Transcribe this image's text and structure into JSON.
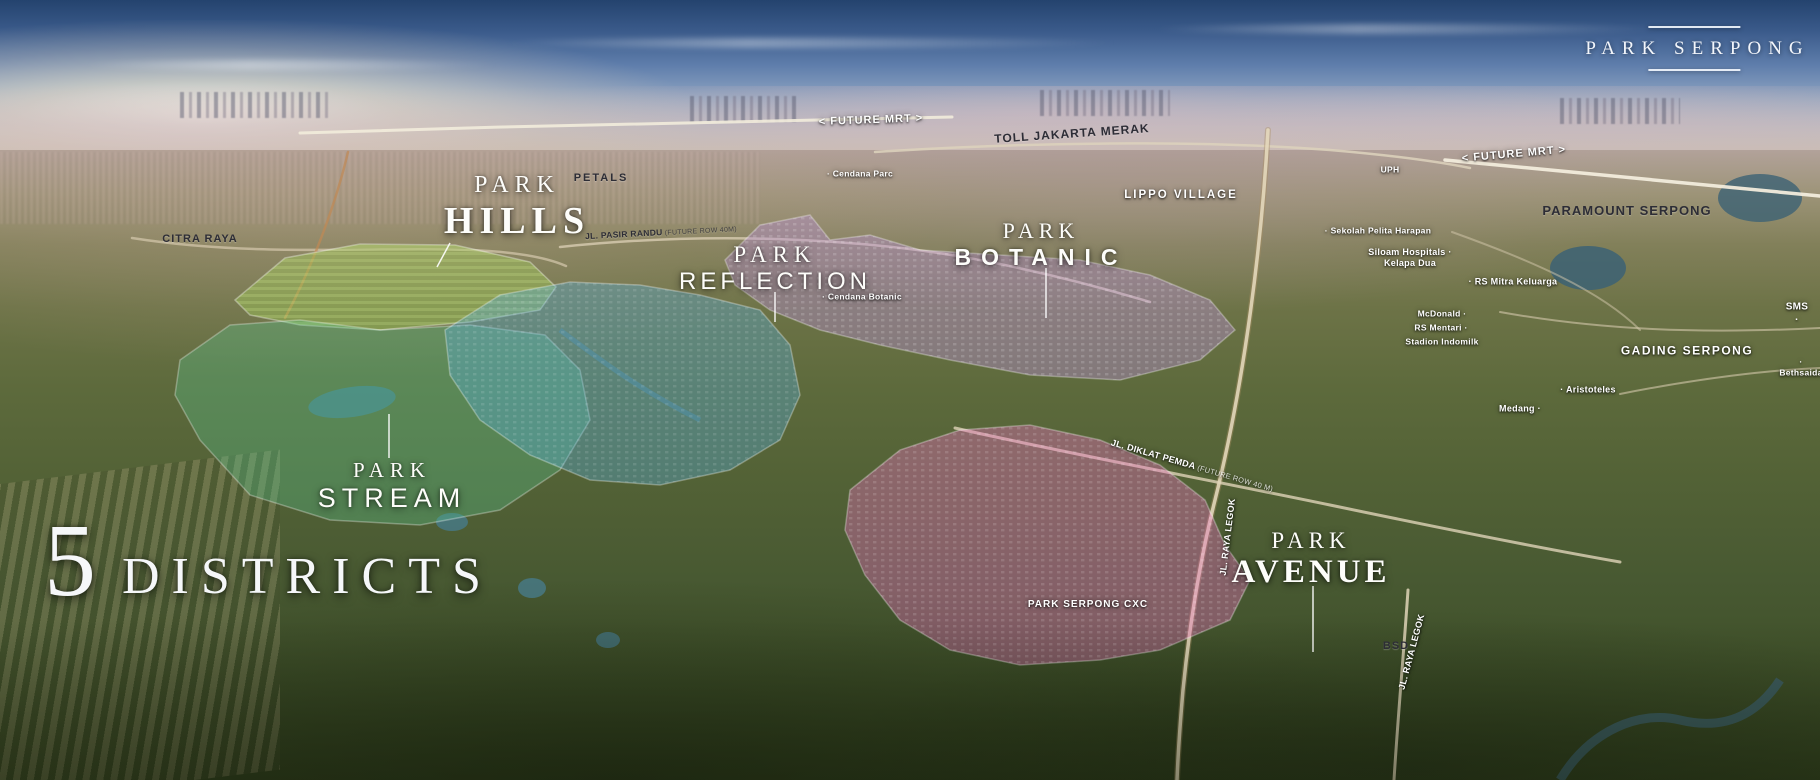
{
  "brand": {
    "name": "PARK SERPONG"
  },
  "headline": {
    "number": "5",
    "word": "DISTRICTS"
  },
  "districts": [
    {
      "id": "hills",
      "kicker": "PARK",
      "name": "HILLS",
      "color": "#a6d45c"
    },
    {
      "id": "reflection",
      "kicker": "PARK",
      "name": "REFLECTION",
      "color": "#57aede"
    },
    {
      "id": "botanic",
      "kicker": "PARK",
      "name": "BOTANIC",
      "color": "#b98fd6"
    },
    {
      "id": "stream",
      "kicker": "PARK",
      "name": "STREAM",
      "color": "#57c48e"
    },
    {
      "id": "avenue",
      "kicker": "PARK",
      "name": "AVENUE",
      "color": "#e96fc0"
    }
  ],
  "landmarks": [
    {
      "id": "future-mrt-left",
      "text": "< FUTURE MRT >",
      "x": 871,
      "y": 121,
      "fs": 11,
      "c": "w",
      "r": -2,
      "ls": 1
    },
    {
      "id": "toll-jakarta-merak",
      "text": "TOLL JAKARTA MERAK",
      "x": 1072,
      "y": 134,
      "fs": 12,
      "c": "d",
      "r": -4,
      "ls": 1
    },
    {
      "id": "cendana-parc",
      "text": "· Cendana Parc",
      "x": 860,
      "y": 174,
      "fs": 8.5,
      "c": "w"
    },
    {
      "id": "lippo-village",
      "text": "LIPPO VILLAGE",
      "x": 1181,
      "y": 195,
      "fs": 11.5,
      "c": "w",
      "ls": 2
    },
    {
      "id": "uph",
      "text": "UPH",
      "x": 1390,
      "y": 170,
      "fs": 8.5,
      "c": "w"
    },
    {
      "id": "future-mrt-right",
      "text": "< FUTURE MRT >",
      "x": 1514,
      "y": 155,
      "fs": 11,
      "c": "w",
      "r": -5,
      "ls": 1
    },
    {
      "id": "paramount-serpong",
      "text": "PARAMOUNT SERPONG",
      "x": 1627,
      "y": 211,
      "fs": 13,
      "c": "d",
      "ls": 1
    },
    {
      "id": "sekolah-pelita-harapan",
      "text": "· Sekolah Pelita Harapan",
      "x": 1378,
      "y": 231,
      "fs": 8.5,
      "c": "w"
    },
    {
      "id": "siloam-hospitals-kelapa-dua",
      "text": "Siloam Hospitals ·\nKelapa Dua",
      "x": 1410,
      "y": 258,
      "fs": 9,
      "c": "w"
    },
    {
      "id": "rs-mitra-keluarga",
      "text": "· RS Mitra Keluarga",
      "x": 1513,
      "y": 282,
      "fs": 9,
      "c": "w"
    },
    {
      "id": "mcdonald",
      "text": "McDonald ·",
      "x": 1442,
      "y": 314,
      "fs": 8.5,
      "c": "w"
    },
    {
      "id": "rs-mentari",
      "text": "RS Mentari ·",
      "x": 1441,
      "y": 328,
      "fs": 8.5,
      "c": "w"
    },
    {
      "id": "stadion-indomilk",
      "text": "Stadion Indomilk",
      "x": 1442,
      "y": 342,
      "fs": 8.5,
      "c": "w"
    },
    {
      "id": "aristoteles",
      "text": "· Aristoteles",
      "x": 1588,
      "y": 390,
      "fs": 9,
      "c": "w"
    },
    {
      "id": "medang",
      "text": "Medang ·",
      "x": 1520,
      "y": 409,
      "fs": 9,
      "c": "w"
    },
    {
      "id": "sms",
      "text": "SMS ·",
      "x": 1797,
      "y": 314,
      "fs": 10,
      "c": "w"
    },
    {
      "id": "gading-serpong",
      "text": "GADING SERPONG",
      "x": 1687,
      "y": 351,
      "fs": 12,
      "c": "w",
      "ls": 1.5
    },
    {
      "id": "bethsaida",
      "text": "· Bethsaida",
      "x": 1801,
      "y": 367,
      "fs": 8.5,
      "c": "w"
    },
    {
      "id": "citra-raya",
      "text": "CITRA RAYA",
      "x": 200,
      "y": 240,
      "fs": 11,
      "c": "d",
      "ls": 1
    },
    {
      "id": "petals",
      "text": "PETALS",
      "x": 601,
      "y": 179,
      "fs": 11,
      "c": "d",
      "ls": 2
    },
    {
      "id": "cendana-botanic",
      "text": "· Cendana Botanic",
      "x": 862,
      "y": 297,
      "fs": 8.5,
      "c": "w"
    },
    {
      "id": "road-jl-pasir-randu",
      "text": "JL. PASIR RANDU",
      "sub": " (FUTURE ROW 40M)",
      "x": 661,
      "y": 233,
      "fs": 8.5,
      "c": "d",
      "r": -3
    },
    {
      "id": "road-jl-diklat-pemda",
      "text": "JL. DIKLAT PEMDA",
      "sub": " (FUTURE ROW 40 M)",
      "x": 1192,
      "y": 466,
      "fs": 9,
      "c": "w",
      "r": 16
    },
    {
      "id": "park-serpong-cxc",
      "text": "PARK SERPONG CXC",
      "x": 1088,
      "y": 605,
      "fs": 10,
      "c": "w",
      "ls": 1
    },
    {
      "id": "road-jl-raya-legok",
      "text": "JL. RAYA LEGOK",
      "x": 1228,
      "y": 537,
      "fs": 9,
      "c": "w",
      "r": -83
    },
    {
      "id": "road-jl-raya-legok-2",
      "text": "JL. RAYA LEGOK",
      "x": 1412,
      "y": 652,
      "fs": 9,
      "c": "w",
      "r": -75
    },
    {
      "id": "bsd",
      "text": "BSD",
      "x": 1396,
      "y": 647,
      "fs": 11,
      "c": "d",
      "ls": 1
    }
  ]
}
